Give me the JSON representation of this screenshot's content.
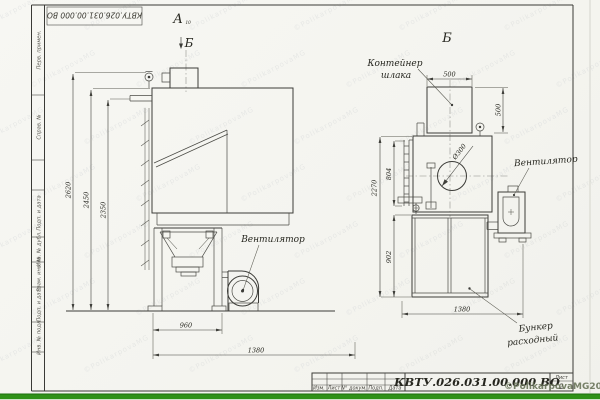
{
  "page": {
    "background": "#f6f6f2",
    "line_color": "#3c3c38",
    "green_bar_color": "#2f9118",
    "copyright": "©PolikarpovaMG2021",
    "watermark_text": "©PolikarpovaMG"
  },
  "frame": {
    "stamp": "КВТУ.026.031.00.000  ВО",
    "side_labels": [
      "Перв. примен.",
      "Справ. №",
      "Подп. и дата",
      "Инв. № дубл.",
      "Взам. инв. №",
      "Подп. и дата",
      "Инв. № подл."
    ]
  },
  "title_block": {
    "cols": [
      "Изм.",
      "Лист",
      "N° докум.",
      "Подп.",
      "Дата"
    ],
    "designation": "КВТУ.026.031.00.000  ВО",
    "sheet_label": "Лист",
    "sheet_number": "2"
  },
  "left_view": {
    "label": "А",
    "label_note": "10",
    "arrow_label": "Б",
    "fan_label": "Вентилятор",
    "dim_2620": "2620",
    "dim_2450": "2450",
    "dim_2350": "2350",
    "dim_960": "960",
    "dim_1380": "1380"
  },
  "right_view": {
    "label": "Б",
    "container_line1": "Контейнер",
    "container_line2": "шлака",
    "fan_label": "Вентилятор",
    "hopper_line1": "Бункер",
    "hopper_line2": "расходный",
    "dim_500_w": "500",
    "dim_500_h": "500",
    "dim_2270": "2270",
    "dim_804": "804",
    "dim_902": "902",
    "dim_1380": "1380",
    "dim_dia": "Ø300"
  }
}
